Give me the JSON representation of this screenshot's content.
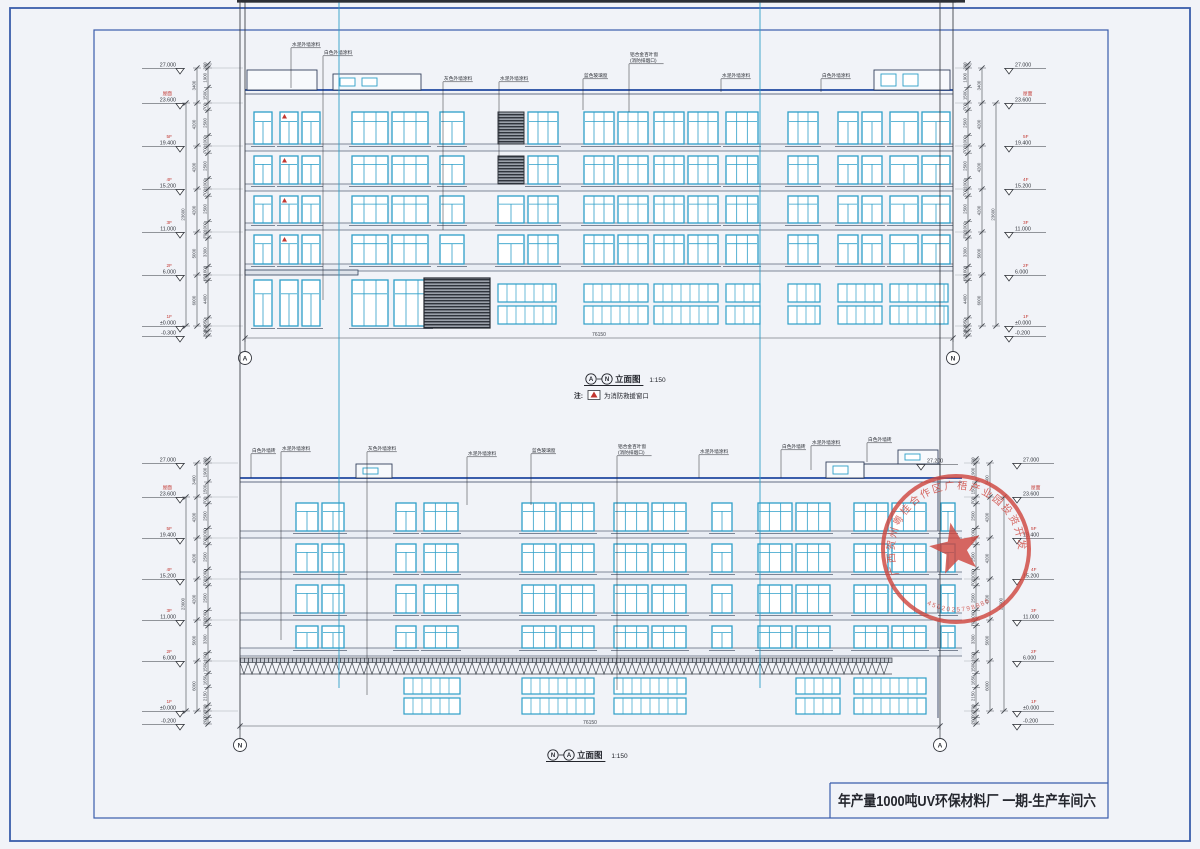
{
  "page": {
    "background": "#e7eaf0",
    "paper": "#f1f3f8",
    "frame_color": "#3a5dab",
    "line_color": "#33415c",
    "window_color": "#2e9fc8",
    "dim_color": "#43474e",
    "accent_red": "#c23630",
    "stamp_red": "#cf4840"
  },
  "title_block": {
    "project_title": "年产量1000吨UV环保材料厂  一期-生产车间六"
  },
  "stamp": {
    "ring_text": "广西贺州粤桂合作区广梧产业园投资开发有限公司",
    "number": "4502025798886"
  },
  "elevations": [
    {
      "id": "elevation-a-n",
      "axis_left": "A",
      "axis_right": "N",
      "title_text": "立面图",
      "title_scale": "1:150",
      "note_prefix": "注:",
      "note_text": "为消防救援窗口",
      "total_width": "76150",
      "total_height": "23600",
      "levels": [
        {
          "label": "",
          "value": "27.000"
        },
        {
          "label": "屋面",
          "value": "23.600"
        },
        {
          "label": "5F",
          "value": "19.400"
        },
        {
          "label": "4F",
          "value": "15.200"
        },
        {
          "label": "3F",
          "value": "11.000"
        },
        {
          "label": "2F",
          "value": "6.000"
        },
        {
          "label": "1F",
          "value": "±0.000"
        }
      ],
      "below_level_left": "-0.300",
      "below_level_right": "-0.200",
      "dim_above": "200",
      "dim_floors": [
        {
          "total": "3400",
          "sub": [
            "1900",
            "1500"
          ]
        },
        {
          "total": "4200",
          "sub": [
            "700",
            "2500",
            "1000"
          ]
        },
        {
          "total": "4200",
          "sub": [
            "700",
            "2500",
            "1000"
          ]
        },
        {
          "total": "4200",
          "sub": [
            "700",
            "2500",
            "1000"
          ]
        },
        {
          "total": "5000",
          "sub": [
            "700",
            "3300",
            "1000"
          ]
        },
        {
          "total": "6000",
          "sub": [
            "650",
            "4400",
            "950"
          ]
        }
      ],
      "dim_below": [
        "200",
        "200"
      ],
      "callouts": [
        {
          "x": 292,
          "y": 46,
          "ty": 88,
          "lines": [
            "水泥外墙涂料"
          ]
        },
        {
          "x": 324,
          "y": 54,
          "ty": 300,
          "lines": [
            "白色外墙涂料"
          ]
        },
        {
          "x": 444,
          "y": 80,
          "ty": 230,
          "lines": [
            "灰色外墙涂料"
          ]
        },
        {
          "x": 500,
          "y": 80,
          "ty": 160,
          "lines": [
            "水泥外墙涂料"
          ]
        },
        {
          "x": 584,
          "y": 77,
          "ty": 110,
          "lines": [
            "蓝色玻璃窗"
          ]
        },
        {
          "x": 630,
          "y": 56,
          "ty": 112,
          "lines": [
            "铝合金百叶窗",
            "(消防排烟口)"
          ]
        },
        {
          "x": 722,
          "y": 77,
          "ty": 92,
          "lines": [
            "水泥外墙涂料"
          ]
        },
        {
          "x": 822,
          "y": 77,
          "ty": 92,
          "lines": [
            "白色外墙涂料"
          ]
        }
      ]
    },
    {
      "id": "elevation-n-a",
      "axis_left": "N",
      "axis_right": "A",
      "title_text": "立面图",
      "title_scale": "1:150",
      "note_prefix": "",
      "note_text": "",
      "total_width": "76150",
      "total_height": "23600",
      "extra_level": "27.200",
      "levels": [
        {
          "label": "",
          "value": "27.000"
        },
        {
          "label": "屋面",
          "value": "23.600"
        },
        {
          "label": "5F",
          "value": "19.400"
        },
        {
          "label": "4F",
          "value": "15.200"
        },
        {
          "label": "3F",
          "value": "11.000"
        },
        {
          "label": "2F",
          "value": "6.000"
        },
        {
          "label": "1F",
          "value": "±0.000"
        }
      ],
      "below_level_left": "-0.200",
      "below_level_right": "-0.200",
      "dim_above": "200",
      "dim_floors": [
        {
          "total": "3400",
          "sub": [
            "1900",
            "1500"
          ]
        },
        {
          "total": "4200",
          "sub": [
            "700",
            "2500",
            "1000"
          ]
        },
        {
          "total": "4200",
          "sub": [
            "700",
            "2500",
            "1000"
          ]
        },
        {
          "total": "4200",
          "sub": [
            "700",
            "2500",
            "1000"
          ]
        },
        {
          "total": "5000",
          "sub": [
            "700",
            "3300",
            "1000"
          ]
        },
        {
          "total": "6000",
          "sub": [
            "1500",
            "1650",
            "2150",
            "700"
          ]
        }
      ],
      "dim_below": [
        "200",
        "200"
      ],
      "callouts": [
        {
          "x": 252,
          "y": 452,
          "ty": 478,
          "lines": [
            "白色外墙砖"
          ]
        },
        {
          "x": 282,
          "y": 450,
          "ty": 640,
          "lines": [
            "水泥外墙涂料"
          ]
        },
        {
          "x": 368,
          "y": 450,
          "ty": 695,
          "lines": [
            "灰色外墙涂料"
          ]
        },
        {
          "x": 468,
          "y": 455,
          "ty": 505,
          "lines": [
            "水泥外墙涂料"
          ]
        },
        {
          "x": 532,
          "y": 452,
          "ty": 505,
          "lines": [
            "蓝色玻璃窗"
          ]
        },
        {
          "x": 618,
          "y": 448,
          "ty": 690,
          "lines": [
            "铝合金百叶窗",
            "(消防排烟口)"
          ]
        },
        {
          "x": 700,
          "y": 453,
          "ty": 478,
          "lines": [
            "水泥外墙涂料"
          ]
        },
        {
          "x": 782,
          "y": 448,
          "ty": 478,
          "lines": [
            "白色外墙砖"
          ]
        },
        {
          "x": 812,
          "y": 444,
          "ty": 470,
          "lines": [
            "水泥外墙涂料"
          ]
        },
        {
          "x": 868,
          "y": 441,
          "ty": 462,
          "lines": [
            "白色外墙砖"
          ]
        }
      ]
    }
  ]
}
